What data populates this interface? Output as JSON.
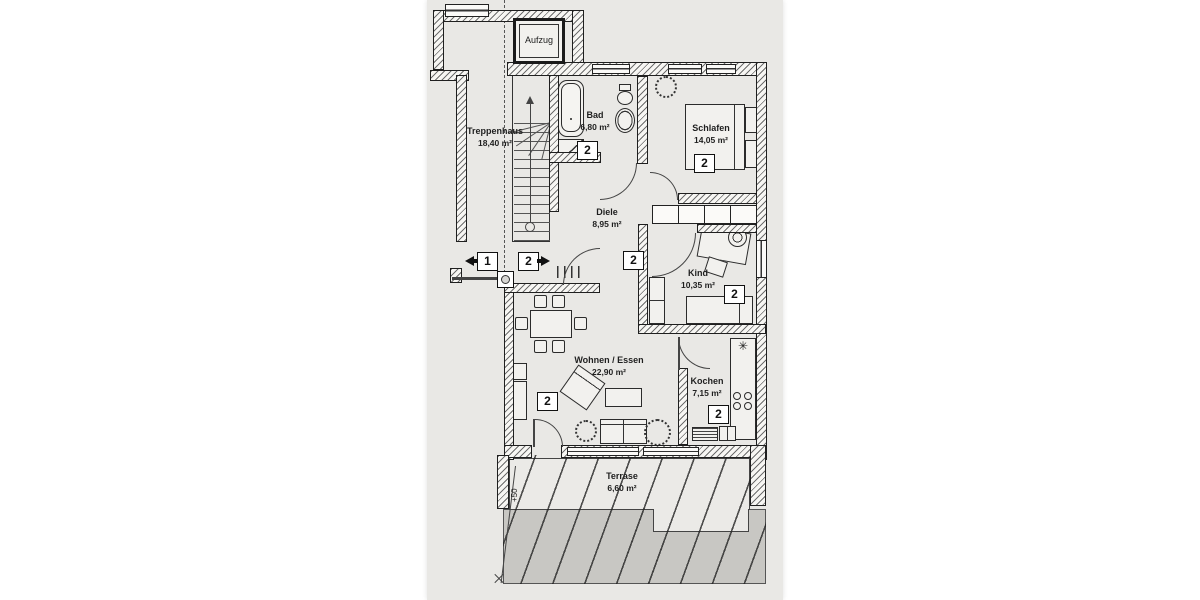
{
  "plan": {
    "title": "Wohnung 2 – Grundriss (floor plan scan)",
    "rooms": {
      "aufzug": {
        "name": "Aufzug"
      },
      "treppenhaus": {
        "name": "Treppenhaus",
        "area": "18,40 m²"
      },
      "bad": {
        "name": "Bad",
        "area": "6,80 m²"
      },
      "schlafen": {
        "name": "Schlafen",
        "area": "14,05 m²"
      },
      "diele": {
        "name": "Diele",
        "area": "8,95 m²"
      },
      "kind": {
        "name": "Kind",
        "area": "10,35 m²"
      },
      "wohnen": {
        "name": "Wohnen / Essen",
        "area": "22,90 m²"
      },
      "kochen": {
        "name": "Kochen",
        "area": "7,15 m²"
      },
      "terrasse": {
        "name": "Terrase",
        "area": "6,60 m²"
      }
    },
    "badges": {
      "unit_1": "1",
      "unit_2": "2"
    },
    "annotations": {
      "level_marker": "+50",
      "freezer_symbol": "✳"
    },
    "colors": {
      "paper": "#e9e8e5",
      "wall_line": "#1f1f1f",
      "gray_area": "#c8c7c3"
    }
  }
}
